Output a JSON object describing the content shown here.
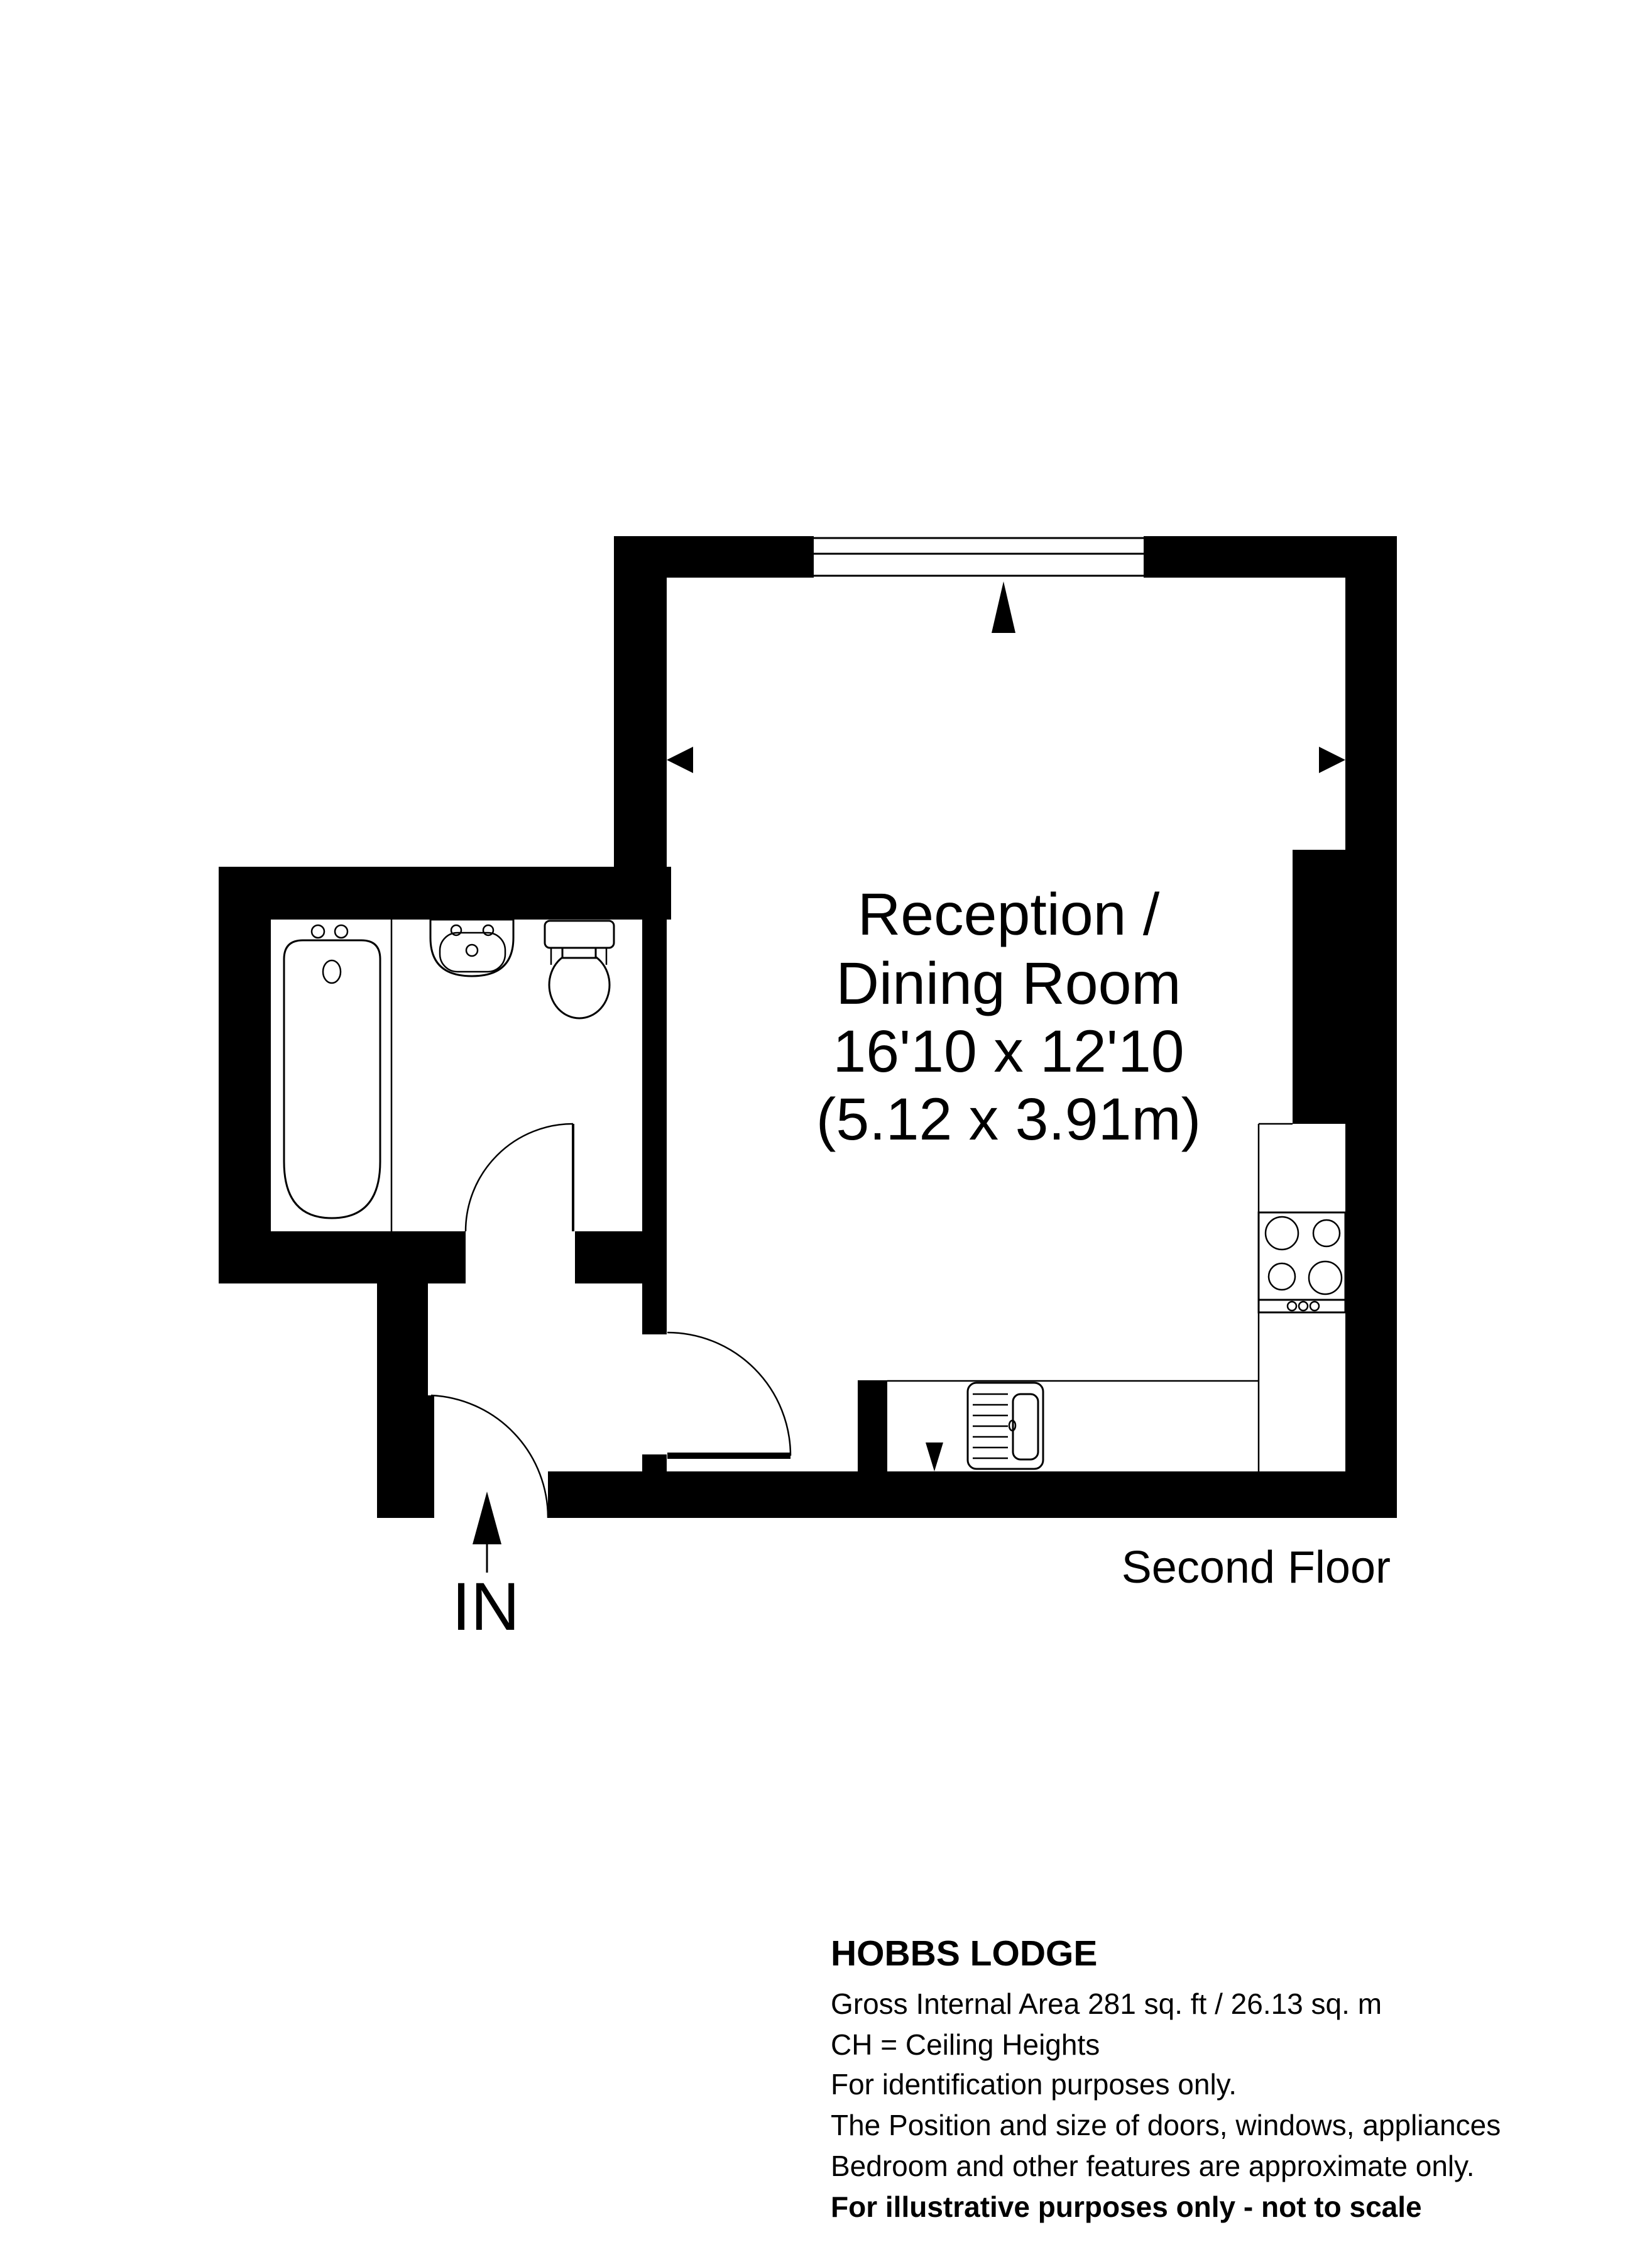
{
  "floorplan": {
    "room_label": {
      "line1": "Reception /",
      "line2": "Dining Room",
      "line3": "16'10 x 12'10",
      "line4": "(5.12 x 3.91m)"
    },
    "floor_label": "Second Floor",
    "entrance_label": "IN"
  },
  "footer": {
    "title": "HOBBS LODGE",
    "lines": [
      "Gross Internal Area 281 sq. ft / 26.13 sq. m",
      "CH = Ceiling Heights",
      "For identification purposes only.",
      "The Position and size of doors, windows, appliances",
      "Bedroom and other features are approximate only.",
      "For illustrative purposes only - not to scale"
    ]
  },
  "colors": {
    "wall": "#000000",
    "background": "#ffffff",
    "text": "#000000"
  }
}
